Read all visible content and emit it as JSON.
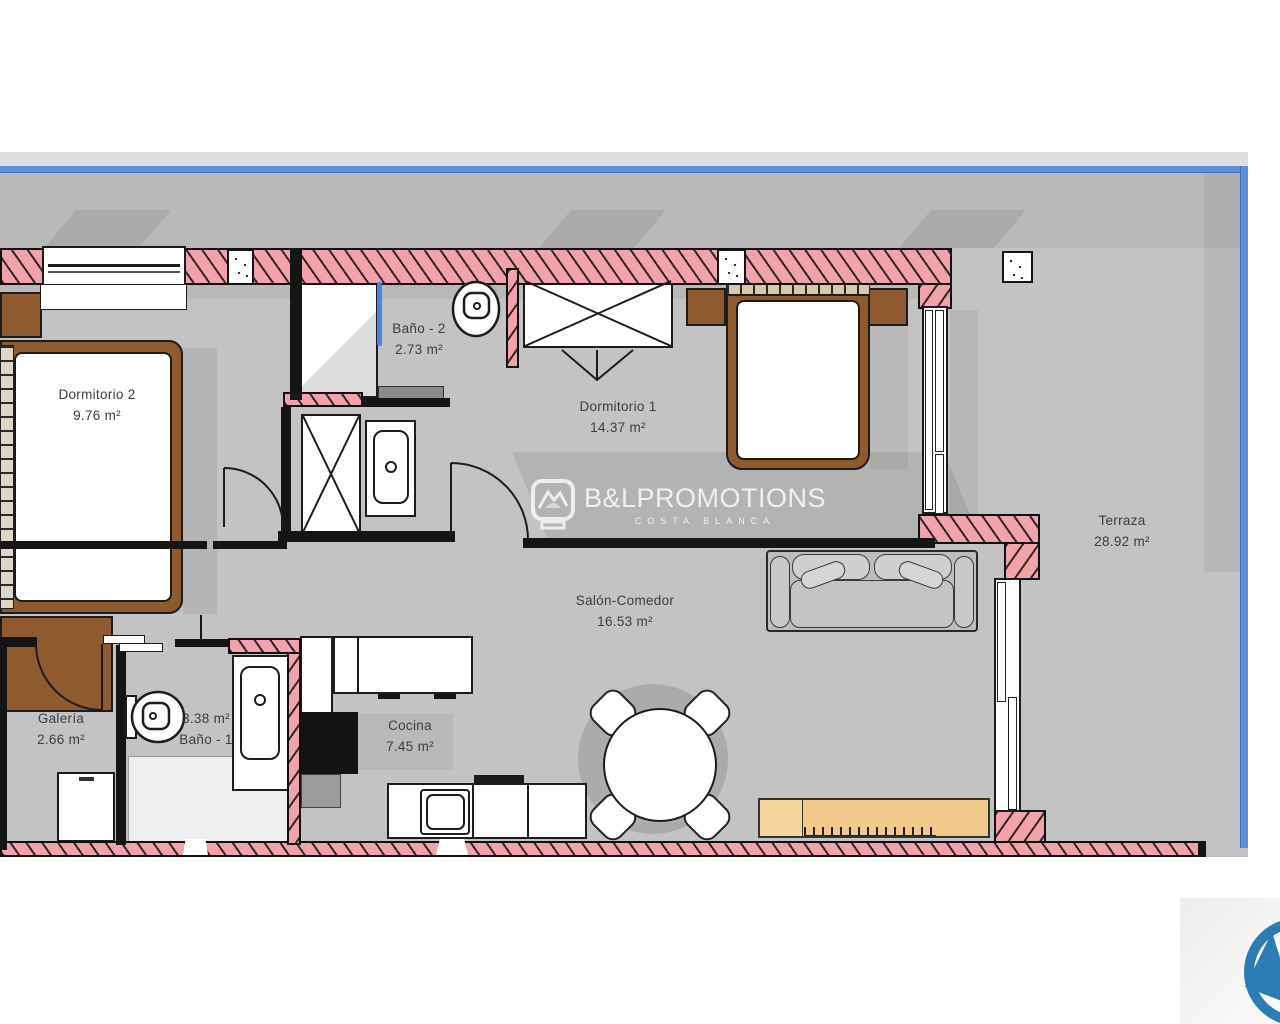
{
  "colors": {
    "floor": "#c3c3c3",
    "wall-pink": "#f2a2ab",
    "railing-blue": "#5f8fd9",
    "glass-blue": "#4a86dd",
    "bed-brown": "#8e5a2e",
    "sideboard-tan": "#f3c98b",
    "label-gray": "#3d3d3d",
    "brand-blue": "#2b7cb3",
    "watermark": "rgba(255,255,255,0.8)"
  },
  "plan": {
    "rooms": [
      {
        "name": "Dormitorio 2",
        "area": "9.76 m²"
      },
      {
        "name": "Baño - 2",
        "area": "2.73 m²"
      },
      {
        "name": "Dormitorio 1",
        "area": "14.37 m²"
      },
      {
        "name": "Terraza",
        "area": "28.92 m²"
      },
      {
        "name": "Salón-Comedor",
        "area": "16.53 m²"
      },
      {
        "name": "Galería",
        "area": "2.66 m²"
      },
      {
        "name": "Baño - 1",
        "area": "3.38 m²"
      },
      {
        "name": "Cocina",
        "area": "7.45 m²"
      }
    ],
    "watermark": {
      "brand": "B&LPROMOTIONS",
      "subtitle": "COSTA BLANCA"
    }
  }
}
